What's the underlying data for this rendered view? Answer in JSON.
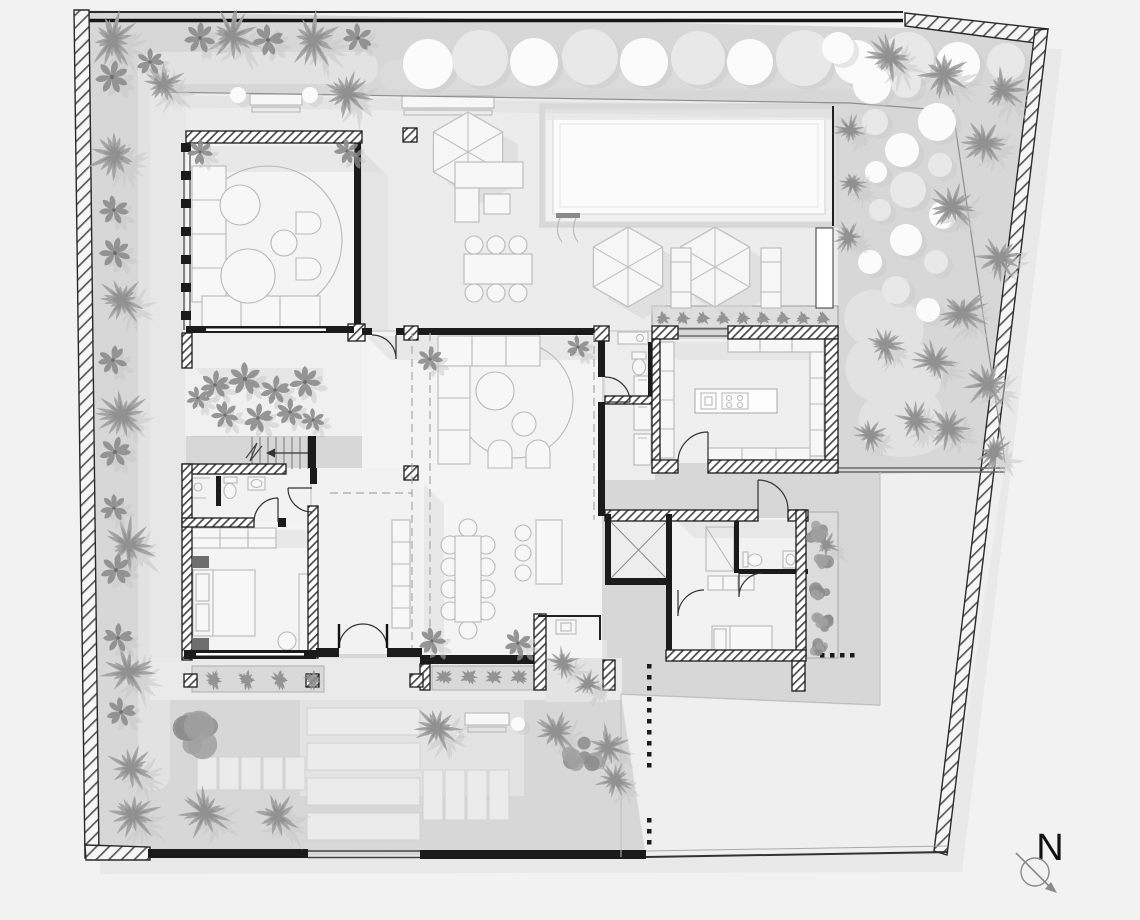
{
  "compass": {
    "label": "N"
  },
  "palette": {
    "page_bg": "#f2f2f2",
    "garden": "#d7d7d7",
    "garden_path": "#e2e2e2",
    "deck": "#ececec",
    "court": "#efefef",
    "floor": "#f4f4f4",
    "floor_dim": "#ededed",
    "pool_water": "#fbfbfb",
    "pool_edge": "#d9d9d9",
    "wall": "#1b1b1b",
    "furn_fill": "#f7f7f7",
    "furn_line": "#b9b9b9",
    "shadow": "#dcdcdc",
    "tree": "#a1a1a1",
    "tree_dark": "#8c8c8c",
    "tree_shadow": "#c8c8c8",
    "shrub_white": "#fbfbfb",
    "shrub_grey": "#e8e8e8",
    "planter_bed": "#dedede"
  },
  "vegetation": {
    "palms": [
      [
        112,
        40,
        32
      ],
      [
        232,
        36,
        30
      ],
      [
        313,
        40,
        32
      ],
      [
        163,
        84,
        26
      ],
      [
        347,
        94,
        28
      ],
      [
        115,
        155,
        32
      ],
      [
        122,
        300,
        28
      ],
      [
        122,
        415,
        30
      ],
      [
        128,
        545,
        31
      ],
      [
        128,
        672,
        30
      ],
      [
        131,
        768,
        28
      ],
      [
        133,
        815,
        30
      ],
      [
        205,
        813,
        29
      ],
      [
        277,
        816,
        30
      ],
      [
        437,
        728,
        27
      ],
      [
        556,
        732,
        27
      ],
      [
        608,
        747,
        26
      ],
      [
        615,
        780,
        22
      ],
      [
        563,
        663,
        19
      ],
      [
        588,
        684,
        17
      ],
      [
        890,
        57,
        28
      ],
      [
        943,
        74,
        30
      ],
      [
        1002,
        90,
        28
      ],
      [
        850,
        130,
        19
      ],
      [
        852,
        183,
        19
      ],
      [
        849,
        237,
        19
      ],
      [
        985,
        143,
        29
      ],
      [
        952,
        207,
        28
      ],
      [
        999,
        258,
        26
      ],
      [
        962,
        313,
        29
      ],
      [
        935,
        362,
        25
      ],
      [
        987,
        384,
        28
      ],
      [
        948,
        428,
        26
      ],
      [
        994,
        452,
        22
      ],
      [
        885,
        345,
        22
      ],
      [
        915,
        420,
        24
      ],
      [
        870,
        435,
        20
      ],
      [
        826,
        545,
        15
      ]
    ],
    "flowers": [
      [
        200,
        38,
        16
      ],
      [
        268,
        40,
        16
      ],
      [
        358,
        38,
        15
      ],
      [
        150,
        62,
        14
      ],
      [
        112,
        77,
        17
      ],
      [
        114,
        210,
        15
      ],
      [
        115,
        253,
        16
      ],
      [
        113,
        360,
        15
      ],
      [
        115,
        452,
        16
      ],
      [
        114,
        508,
        14
      ],
      [
        116,
        570,
        16
      ],
      [
        118,
        638,
        15
      ],
      [
        121,
        712,
        15
      ],
      [
        200,
        152,
        13
      ],
      [
        347,
        151,
        13
      ],
      [
        430,
        359,
        13
      ],
      [
        578,
        347,
        12
      ],
      [
        432,
        641,
        14
      ],
      [
        518,
        643,
        14
      ],
      [
        215,
        385,
        15
      ],
      [
        245,
        379,
        17
      ],
      [
        275,
        390,
        15
      ],
      [
        305,
        382,
        16
      ],
      [
        225,
        415,
        14
      ],
      [
        258,
        418,
        15
      ],
      [
        290,
        412,
        14
      ],
      [
        313,
        420,
        12
      ],
      [
        198,
        398,
        12
      ]
    ],
    "tropical": [
      [
        200,
        730,
        32
      ],
      [
        582,
        758,
        22
      ],
      [
        818,
        530,
        15
      ],
      [
        827,
        562,
        13
      ],
      [
        817,
        592,
        14
      ],
      [
        825,
        621,
        13
      ],
      [
        819,
        646,
        11
      ]
    ],
    "shrubs": [
      [
        428,
        64,
        25,
        "w"
      ],
      [
        480,
        58,
        28,
        "g"
      ],
      [
        534,
        62,
        24,
        "w"
      ],
      [
        590,
        57,
        28,
        "g"
      ],
      [
        644,
        62,
        24,
        "w"
      ],
      [
        698,
        58,
        27,
        "g"
      ],
      [
        750,
        62,
        23,
        "w"
      ],
      [
        804,
        58,
        28,
        "g"
      ],
      [
        856,
        62,
        22,
        "w"
      ],
      [
        908,
        58,
        26,
        "g"
      ],
      [
        958,
        64,
        22,
        "w"
      ],
      [
        1006,
        62,
        19,
        "g"
      ],
      [
        838,
        48,
        16,
        "w"
      ],
      [
        872,
        85,
        19,
        "w"
      ],
      [
        906,
        83,
        15,
        "g"
      ],
      [
        937,
        122,
        19,
        "w"
      ],
      [
        875,
        122,
        13,
        "g"
      ],
      [
        902,
        150,
        17,
        "w"
      ],
      [
        940,
        165,
        12,
        "g"
      ],
      [
        876,
        172,
        11,
        "w"
      ],
      [
        908,
        190,
        18,
        "g"
      ],
      [
        943,
        215,
        14,
        "w"
      ],
      [
        880,
        210,
        11,
        "g"
      ],
      [
        906,
        240,
        16,
        "w"
      ],
      [
        936,
        262,
        12,
        "g"
      ],
      [
        870,
        262,
        12,
        "w"
      ],
      [
        896,
        290,
        14,
        "g"
      ],
      [
        928,
        310,
        12,
        "w"
      ],
      [
        238,
        95,
        8,
        "w"
      ],
      [
        310,
        95,
        8,
        "w"
      ],
      [
        452,
        733,
        7,
        "w"
      ],
      [
        518,
        724,
        7,
        "w"
      ]
    ],
    "planter_rows": [
      {
        "x": 663,
        "y": 318,
        "n": 9,
        "dx": 20,
        "r": 8
      },
      {
        "x": 214,
        "y": 680,
        "n": 4,
        "dx": 33,
        "r": 11
      },
      {
        "x": 444,
        "y": 677,
        "n": 4,
        "dx": 25,
        "r": 10
      }
    ]
  },
  "paving": {
    "slab_groups": [
      {
        "x": 197,
        "y": 757,
        "cols": 5,
        "rows": 1,
        "w": 20,
        "h": 33,
        "gx": 2,
        "gy": 0
      },
      {
        "x": 307,
        "y": 708,
        "cols": 1,
        "rows": 4,
        "w": 113,
        "h": 27,
        "gx": 0,
        "gy": 8
      },
      {
        "x": 423,
        "y": 770,
        "cols": 4,
        "rows": 1,
        "w": 20,
        "h": 50,
        "gx": 2,
        "gy": 0
      }
    ],
    "dot_runs": [
      {
        "x": 649,
        "y": 666,
        "n": 10,
        "dx": 0,
        "dy": 11
      },
      {
        "x": 649,
        "y": 820,
        "n": 3,
        "dx": 0,
        "dy": 11
      },
      {
        "x": 822,
        "y": 655,
        "n": 4,
        "dx": 10,
        "dy": 0
      }
    ]
  }
}
